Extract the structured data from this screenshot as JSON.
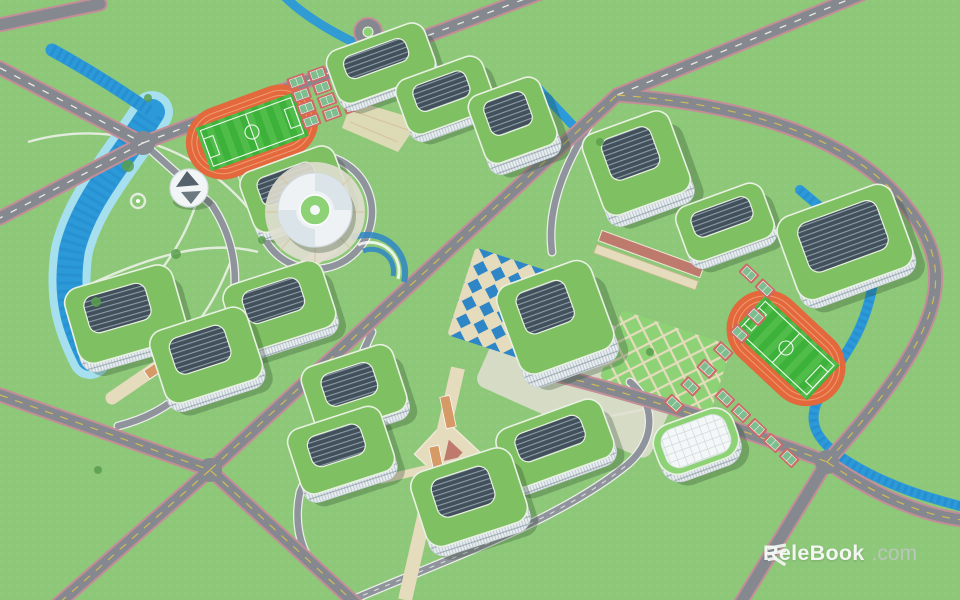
{
  "watermark": {
    "brand": "ReleBook",
    "tld": ".com"
  },
  "scene": {
    "colors": {
      "grass": "#8dc778",
      "grassLight": "#9ad083",
      "road": "#85898f",
      "roadEdge": "#c48e98",
      "roadLineW": "#f5f5ee",
      "roadLineY": "#d8c14e",
      "campusRoad": "#8f949c",
      "campusRoadEdge": "#eceeea",
      "pathWhite": "#f0f2ec",
      "pavingTan": "#e5dbbd",
      "pavingWarm": "#d6c69e",
      "plazaPale": "#e0ded0",
      "bridge": "#d59a66",
      "corridorRed": "#bf7a6e",
      "roof": "#7fc062",
      "lawn": "#8ed276",
      "facade": "#e9eef1",
      "facadeShade": "#bfcad1",
      "windowBand": "#72828d",
      "courtyard": "#41505a",
      "courtyardLine": "#9fb0ba",
      "track": "#e3683c",
      "trackLight": "#f09a72",
      "field": "#3db23a",
      "fieldLight": "#5ec455",
      "water": "#2c99d8",
      "waterDeep": "#1d7cc0",
      "waterBank": "#a6e0ee",
      "plazaBlue": "#2f86c6",
      "courtRed": "#cd6a68",
      "courtGreen": "#7dbd8e",
      "treeGreen": "#5a9e4f",
      "domeDark": "#55616b",
      "shadow": "rgba(36,66,38,0.28)",
      "wmText": "#f3f6f2",
      "wmDim": "#b9c6bb"
    }
  }
}
